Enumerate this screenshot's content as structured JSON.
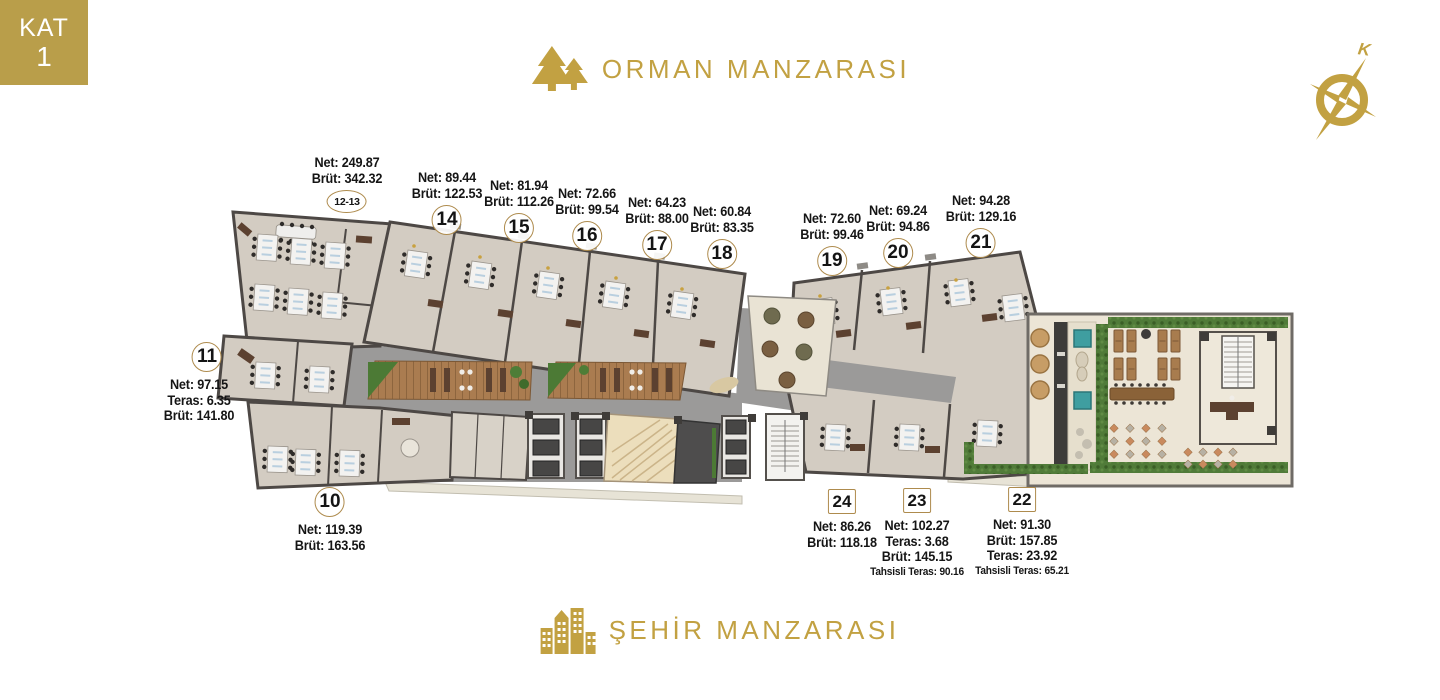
{
  "floor_badge": {
    "kat": "KAT",
    "number": "1"
  },
  "views": {
    "top": "ORMAN MANZARASI",
    "bottom": "ŞEHİR MANZARASI"
  },
  "compass": {
    "north_label": "K"
  },
  "colors": {
    "gold": "#C2A142",
    "badge_border": "#AE8B4D",
    "wall": "#4D4845",
    "floor": "#D3CCC2",
    "plaza": "#9B9A99",
    "wood_deck": "#AA7C50",
    "terrace": "#ECE5D6",
    "hedge": "#507B39",
    "teal_accent": "#3F9EA0"
  },
  "units": [
    {
      "no": "12-13",
      "badge": "pill",
      "lines": [
        "Net: 249.87",
        "Brüt: 342.32"
      ]
    },
    {
      "no": "14",
      "badge": "circle",
      "lines": [
        "Net: 89.44",
        "Brüt: 122.53"
      ]
    },
    {
      "no": "15",
      "badge": "circle",
      "lines": [
        "Net: 81.94",
        "Brüt: 112.26"
      ]
    },
    {
      "no": "16",
      "badge": "circle",
      "lines": [
        "Net: 72.66",
        "Brüt: 99.54"
      ]
    },
    {
      "no": "17",
      "badge": "circle",
      "lines": [
        "Net: 64.23",
        "Brüt: 88.00"
      ]
    },
    {
      "no": "18",
      "badge": "circle",
      "lines": [
        "Net: 60.84",
        "Brüt: 83.35"
      ]
    },
    {
      "no": "19",
      "badge": "circle",
      "lines": [
        "Net: 72.60",
        "Brüt: 99.46"
      ]
    },
    {
      "no": "20",
      "badge": "circle",
      "lines": [
        "Net: 69.24",
        "Brüt: 94.86"
      ]
    },
    {
      "no": "21",
      "badge": "circle",
      "lines": [
        "Net: 94.28",
        "Brüt: 129.16"
      ]
    },
    {
      "no": "11",
      "badge": "circle",
      "lines": [
        "Net: 97.15",
        "Teras: 6.35",
        "Brüt: 141.80"
      ]
    },
    {
      "no": "10",
      "badge": "circle",
      "lines": [
        "Net: 119.39",
        "Brüt: 163.56"
      ]
    },
    {
      "no": "24",
      "badge": "square",
      "lines": [
        "Net: 86.26",
        "Brüt: 118.18"
      ]
    },
    {
      "no": "23",
      "badge": "square",
      "lines": [
        "Net: 102.27",
        "Teras: 3.68",
        "Brüt: 145.15",
        "Tahsisli Teras: 90.16"
      ]
    },
    {
      "no": "22",
      "badge": "square",
      "lines": [
        "Net: 91.30",
        "Brüt: 157.85",
        "Teras: 23.92",
        "Tahsisli Teras: 65.21"
      ]
    }
  ]
}
